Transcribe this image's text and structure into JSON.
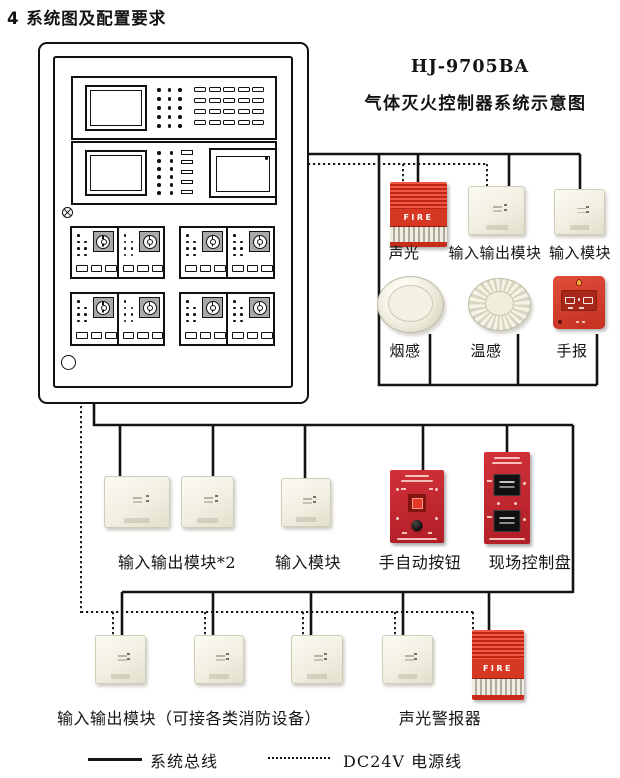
{
  "page": {
    "title": "4 系统图及配置要求"
  },
  "diagram": {
    "model": "HJ-9705BA",
    "subtitle": "气体灭火控制器系统示意图",
    "fire_label": "FIRE",
    "labels": {
      "sound_light": "声光",
      "io_module": "输入输出模块",
      "input_module": "输入模块",
      "smoke": "烟感",
      "heat": "温感",
      "manual_call": "手报",
      "io_module_x2": "输入输出模块*2",
      "manual_auto": "手自动按钮",
      "field_panel": "现场控制盘",
      "io_module_devices": "输入输出模块（可接各类消防设备）",
      "sound_light_alarm": "声光警报器"
    },
    "legend": {
      "system_bus": "系统总线",
      "power_line": "DC24V 电源线"
    },
    "colors": {
      "alarm_red": "#d63723",
      "panel_red": "#c4272b",
      "module_ivory": "#f1efe1",
      "wire_black": "#141414"
    }
  }
}
